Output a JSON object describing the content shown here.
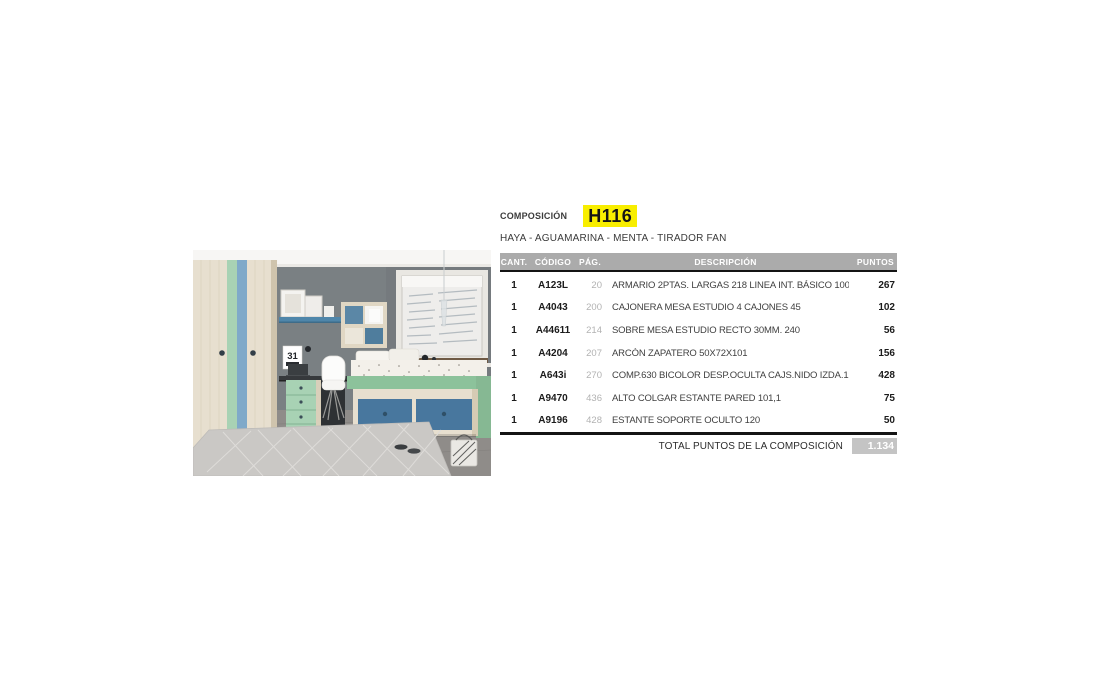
{
  "composition": {
    "label": "COMPOSICIÓN",
    "code": "H116",
    "code_highlight": "#f8ee00",
    "finishes": "HAYA - AGUAMARINA - MENTA - TIRADOR FAN"
  },
  "table": {
    "headers": [
      "CANT.",
      "CÓDIGO",
      "PÁG.",
      "DESCRIPCIÓN",
      "PUNTOS"
    ],
    "rows": [
      {
        "cant": "1",
        "codigo": "A123L",
        "pag": "20",
        "descripcion": "ARMARIO 2PTAS. LARGAS 218 LINEA INT. BÁSICO 100,2",
        "puntos": "267"
      },
      {
        "cant": "1",
        "codigo": "A4043",
        "pag": "200",
        "descripcion": "CAJONERA MESA ESTUDIO 4 CAJONES 45",
        "puntos": "102"
      },
      {
        "cant": "1",
        "codigo": "A44611",
        "pag": "214",
        "descripcion": "SOBRE MESA ESTUDIO RECTO 30MM. 240",
        "puntos": "56"
      },
      {
        "cant": "1",
        "codigo": "A4204",
        "pag": "207",
        "descripcion": "ARCÓN ZAPATERO 50X72X101",
        "puntos": "156"
      },
      {
        "cant": "1",
        "codigo": "A643i",
        "pag": "270",
        "descripcion": "COMP.630 BICOLOR DESP.OCULTA CAJS.NIDO IZDA.190X90",
        "puntos": "428"
      },
      {
        "cant": "1",
        "codigo": "A9470",
        "pag": "436",
        "descripcion": "ALTO COLGAR ESTANTE PARED 101,1",
        "puntos": "75"
      },
      {
        "cant": "1",
        "codigo": "A9196",
        "pag": "428",
        "descripcion": "ESTANTE SOPORTE OCULTO 120",
        "puntos": "50"
      }
    ],
    "total_label": "TOTAL PUNTOS DE LA COMPOSICIÓN",
    "total_value": "1.134"
  },
  "photo": {
    "description": "Dormitorio juvenil: armario de haya con franjas aguamarina y menta, estantería cubo, escritorio con cajonera menta, silla blanca y cama nido con cajones azules junto a la ventana",
    "palette": {
      "wall": "#7a8083",
      "wood": "#e7dfcf",
      "mint": "#a8d2b4",
      "aqua": "#7fa9c9",
      "shelf_blue": "#4f86aa",
      "bed_green": "#8cc29b",
      "drawer_blue": "#48779e",
      "floor": "#8f8c89",
      "rug": "#cac8c5"
    }
  }
}
